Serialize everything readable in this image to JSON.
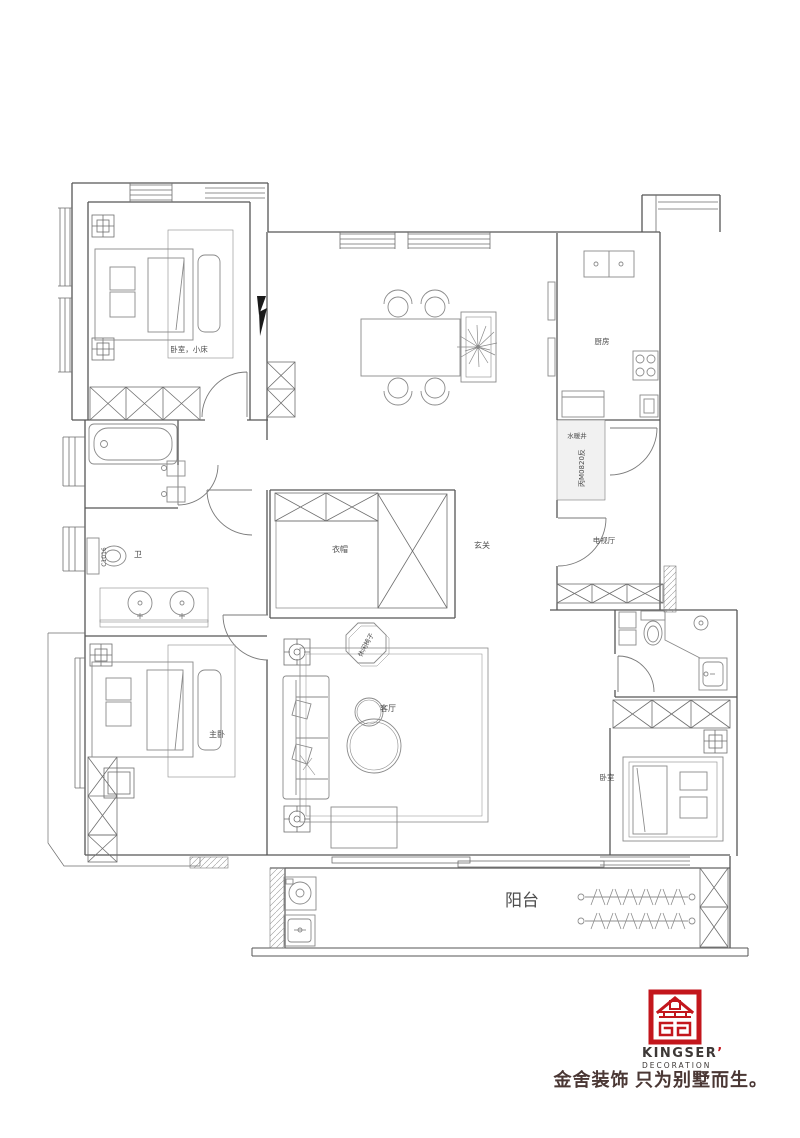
{
  "page": {
    "background": "#ffffff"
  },
  "labels": {
    "bedroom_child": "卧室，小床",
    "cloakroom": "衣帽",
    "entry": "玄关",
    "kitchen": "厨房",
    "shaft": "水暖井",
    "entry_door_code": "丙M0820反",
    "tv_hall": "电视厅",
    "bath": "卫",
    "window_code": "C1016",
    "master_bedroom": "主卧",
    "living_room": "客厅",
    "leisure_chair": "休闲椅子",
    "bedroom": "卧室",
    "balcony": "阳台"
  },
  "logo": {
    "brand": "KINGSER",
    "brand_mark": "’",
    "subtitle": "DECORATION",
    "tagline": "金舍装饰 只为别墅而生。",
    "accent_color": "#c3161c",
    "text_color": "#3d3836",
    "tagline_color": "#4a3734"
  },
  "drawing": {
    "wall_color": "#565656",
    "line_color": "#6f6f6f",
    "furniture_color": "#8a8a8a",
    "label_color": "#4d4d4d",
    "background": "#ffffff"
  }
}
